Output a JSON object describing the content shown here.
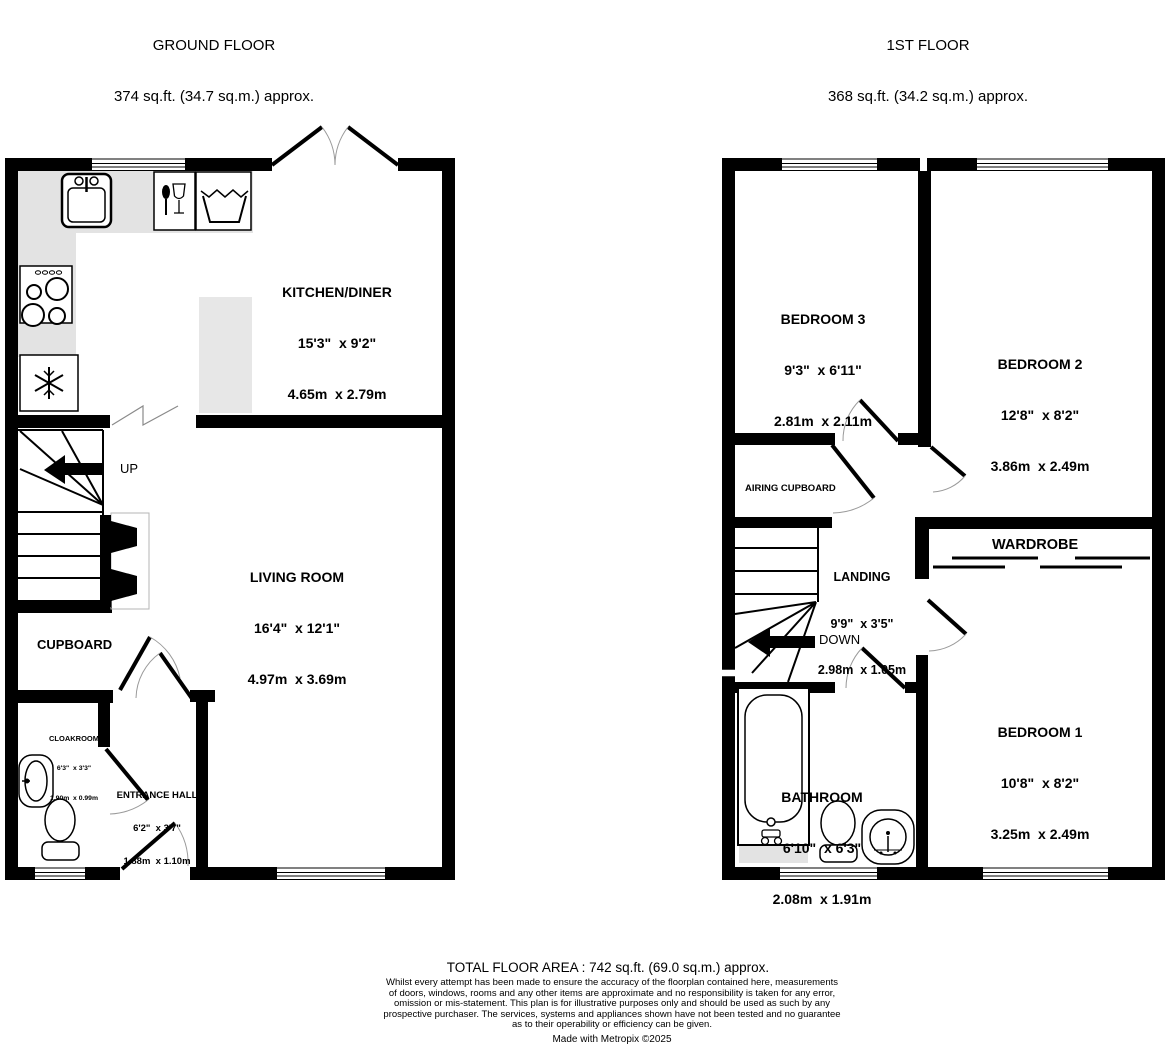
{
  "headers": {
    "ground": {
      "title": "GROUND FLOOR",
      "area": "374 sq.ft. (34.7 sq.m.) approx."
    },
    "first": {
      "title": "1ST FLOOR",
      "area": "368 sq.ft. (34.2 sq.m.) approx."
    }
  },
  "ground_floor": {
    "kitchen_diner": {
      "name": "KITCHEN/DINER",
      "imperial": "15'3\"  x 9'2\"",
      "metric": "4.65m  x 2.79m"
    },
    "living_room": {
      "name": "LIVING ROOM",
      "imperial": "16'4\"  x 12'1\"",
      "metric": "4.97m  x 3.69m"
    },
    "cupboard": {
      "name": "CUPBOARD"
    },
    "cloakroom": {
      "name": "CLOAKROOM",
      "imperial": "6'3\"  x 3'3\"",
      "metric": "1.90m  x 0.99m"
    },
    "entrance_hall": {
      "name": "ENTRANCE HALL",
      "imperial": "6'2\"  x 3'7\"",
      "metric": "1.88m  x 1.10m"
    },
    "stairs_label": "UP"
  },
  "first_floor": {
    "bedroom3": {
      "name": "BEDROOM 3",
      "imperial": "9'3\"  x 6'11\"",
      "metric": "2.81m  x 2.11m"
    },
    "bedroom2": {
      "name": "BEDROOM 2",
      "imperial": "12'8\"  x 8'2\"",
      "metric": "3.86m  x 2.49m"
    },
    "bedroom1": {
      "name": "BEDROOM 1",
      "imperial": "10'8\"  x 8'2\"",
      "metric": "3.25m  x 2.49m"
    },
    "airing_cupboard": {
      "name": "AIRING CUPBOARD"
    },
    "landing": {
      "name": "LANDING",
      "imperial": "9'9\"  x 3'5\"",
      "metric": "2.98m  x 1.05m"
    },
    "wardrobe": {
      "name": "WARDROBE"
    },
    "bathroom": {
      "name": "BATHROOM",
      "imperial": "6'10\"  x 6'3\"",
      "metric": "2.08m  x 1.91m"
    },
    "stairs_label": "DOWN"
  },
  "footer": {
    "total": "TOTAL FLOOR AREA : 742 sq.ft. (69.0 sq.m.) approx.",
    "disclaimer": [
      "Whilst every attempt has been made to ensure the accuracy of the floorplan contained here, measurements",
      "of doors, windows, rooms and any other items are approximate and no responsibility is taken for any error,",
      "omission or mis-statement. This plan is for illustrative purposes only and should be used as such by any",
      "prospective purchaser. The services, systems and appliances shown have not been tested and no guarantee",
      "as to their operability or efficiency can be given."
    ],
    "credit": "Made with Metropix ©2025"
  },
  "icons": {
    "kitchen": [
      "sink-icon",
      "dishwasher-icon",
      "washing-machine-icon",
      "hob-icon",
      "freezer-icon"
    ],
    "cloakroom": [
      "basin-icon",
      "toilet-icon"
    ],
    "bathroom": [
      "bath-icon",
      "toilet-icon",
      "basin-icon"
    ],
    "stairs": [
      "up-arrow-icon",
      "down-arrow-icon"
    ]
  },
  "colors": {
    "wall": "#000000",
    "counter": "#e3e3e3",
    "door_arc": "#9a9a9a",
    "background": "#ffffff"
  }
}
